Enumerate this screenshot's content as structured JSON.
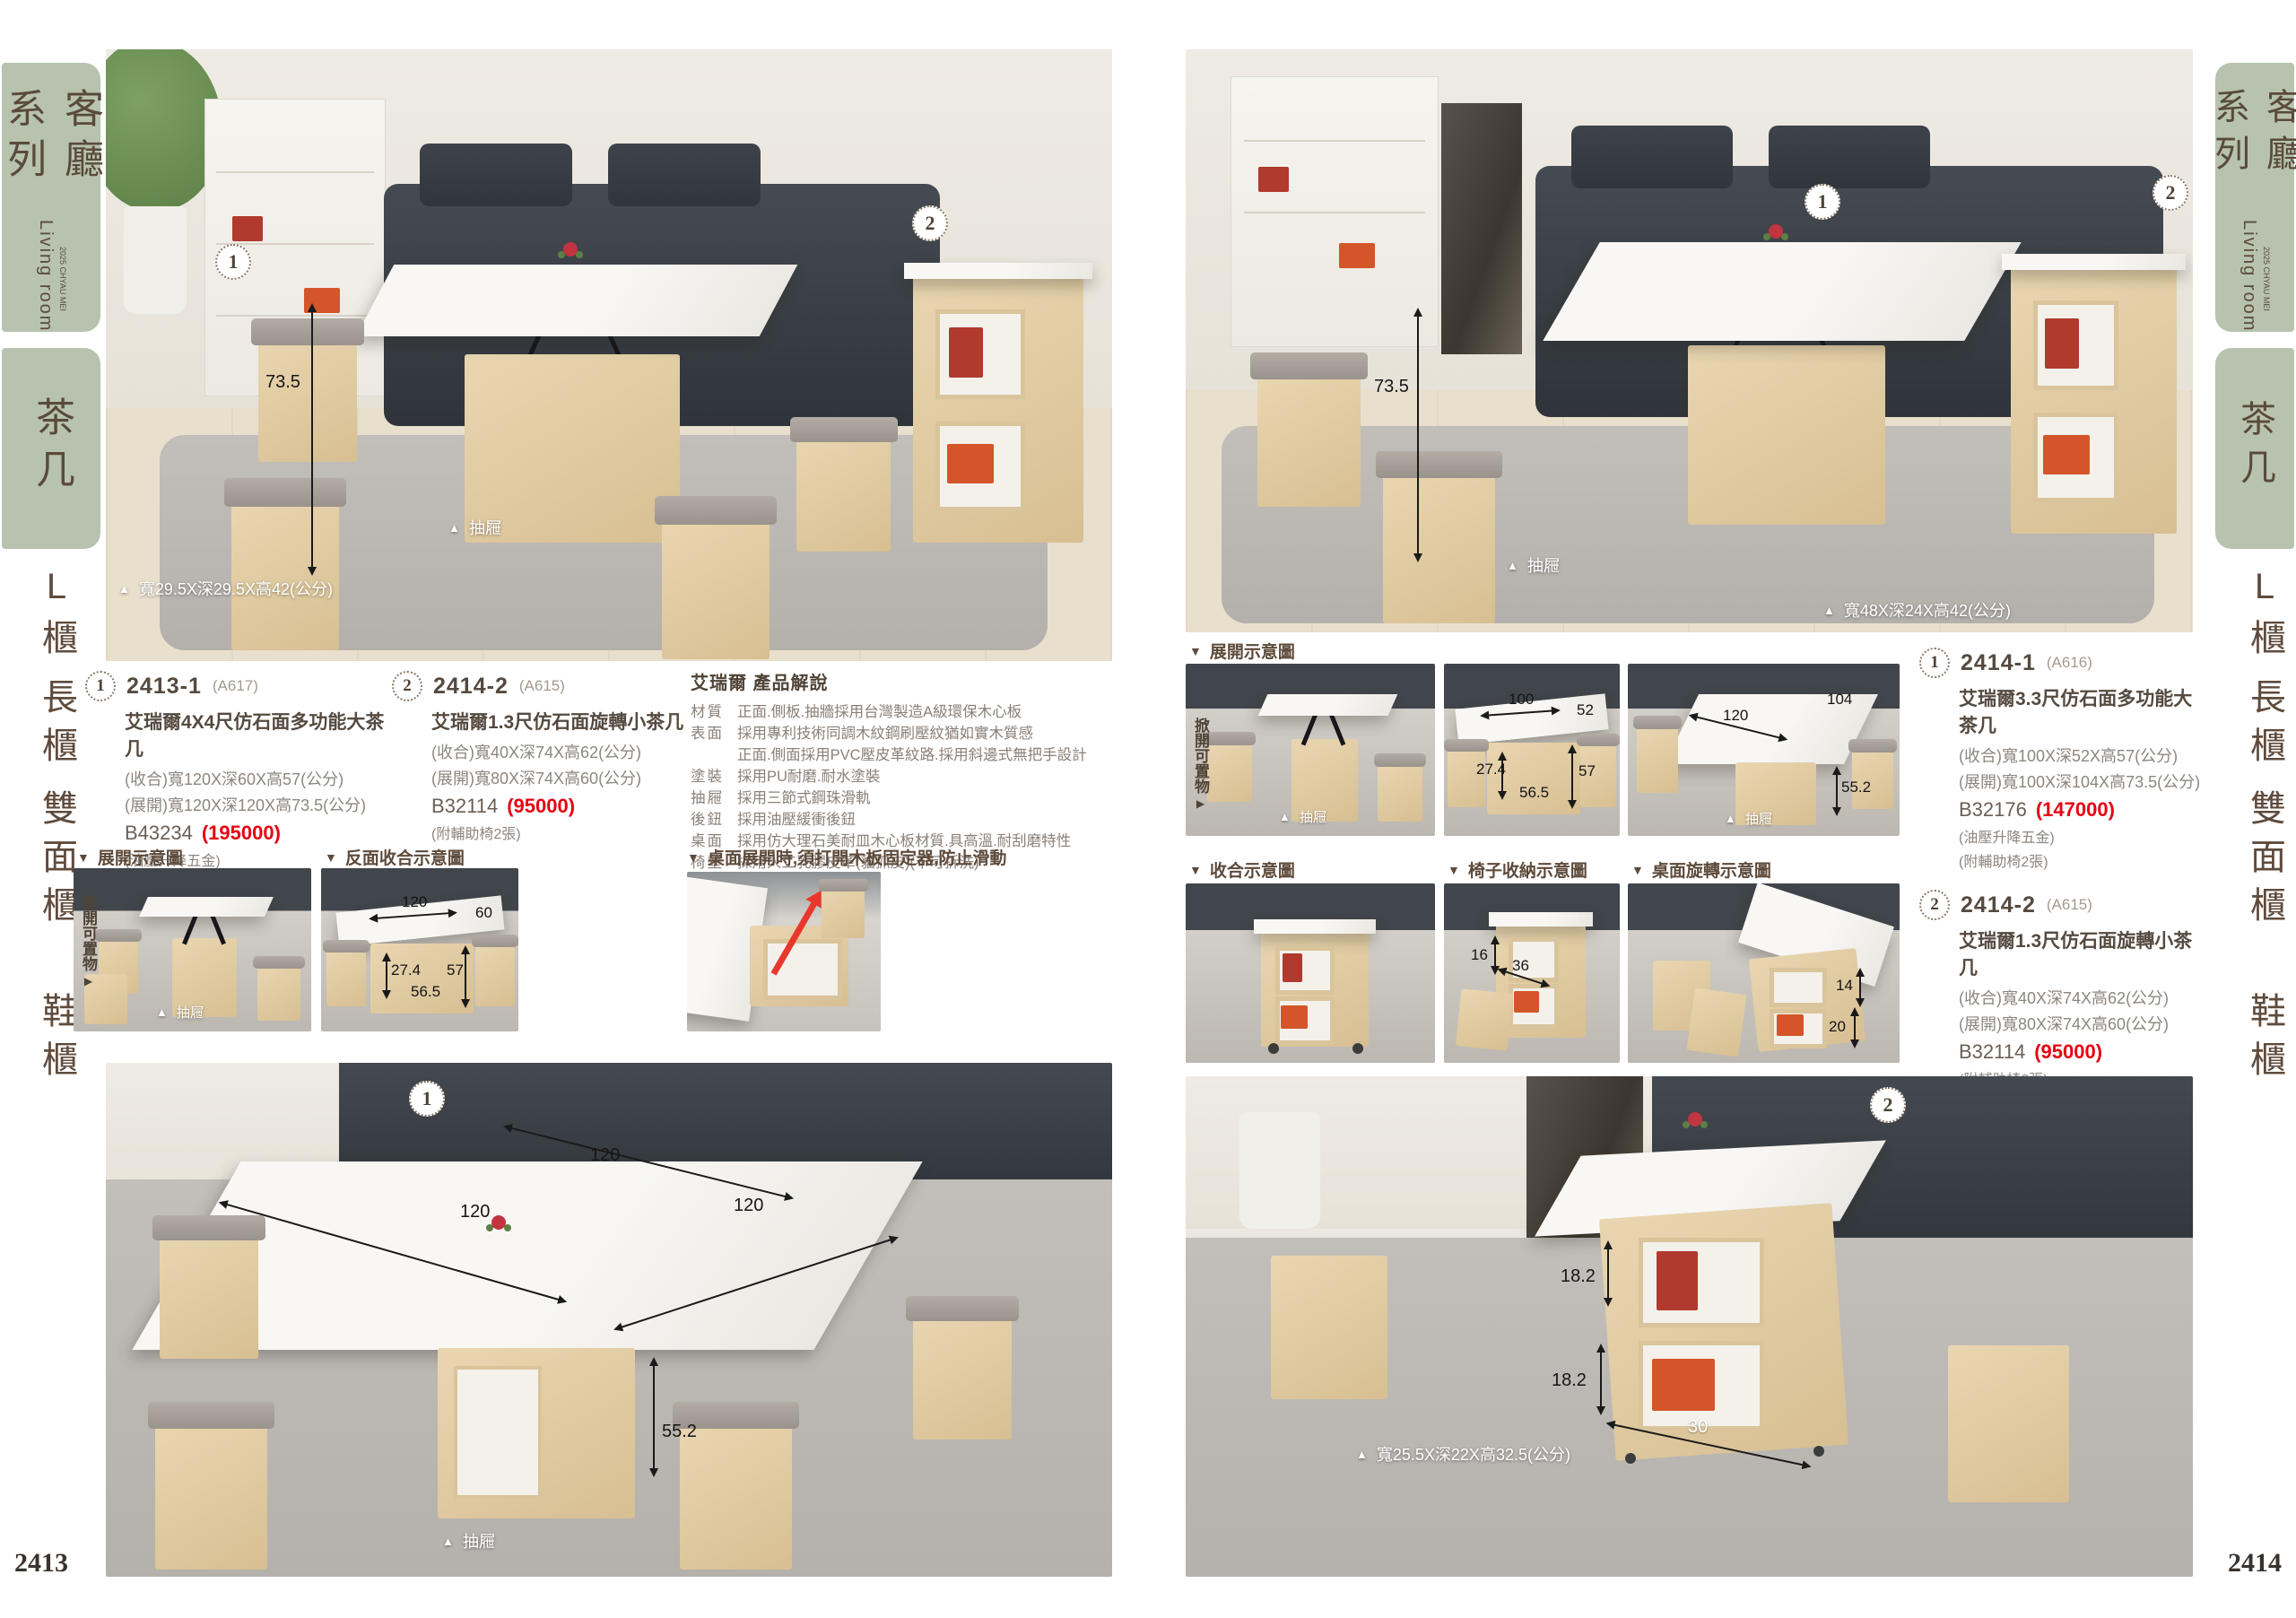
{
  "icons": {
    "up": "▲",
    "down": "▼",
    "right": "▶"
  },
  "page": {
    "left_number": "2413",
    "right_number": "2414"
  },
  "sidebar": {
    "series": "客廳系列",
    "series_en": "Living room",
    "series_tag": "2025 CHYAU MEI",
    "active": "茶几",
    "nav": [
      "L櫃",
      "長櫃",
      "雙面櫃",
      "鞋櫃"
    ]
  },
  "left_page": {
    "hero": {
      "badge1": "1",
      "badge2": "2",
      "height": "73.5",
      "drawer": "抽屜",
      "stool_size": "寬29.5X深29.5X高42(公分)"
    },
    "product1": {
      "badge": "1",
      "model": "2413-1",
      "code": "(A617)",
      "name": "艾瑞爾4X4尺仿石面多功能大茶几",
      "spec_closed": "(收合)寬120X深60X高57(公分)",
      "spec_open": "(展開)寬120X深120X高73.5(公分)",
      "sku": "B43234",
      "price": "(195000)",
      "note1": "(油壓升降五金)",
      "note2": "(附輔助椅4張)"
    },
    "product2": {
      "badge": "2",
      "model": "2414-2",
      "code": "(A615)",
      "name": "艾瑞爾1.3尺仿石面旋轉小茶几",
      "spec_closed": "(收合)寬40X深74X高62(公分)",
      "spec_open": "(展開)寬80X深74X高60(公分)",
      "sku": "B32114",
      "price": "(95000)",
      "note1": "(附輔助椅2張)"
    },
    "desc": {
      "title": "艾瑞爾 產品解說",
      "rows": [
        {
          "label": "材質",
          "text": "正面.側板.抽牆採用台灣製造A級環保木心板"
        },
        {
          "label": "表面",
          "text": "採用專利技術同調木紋鋼刷壓紋猶如實木質感"
        },
        {
          "label": "",
          "text": "正面.側面採用PVC壓皮革紋路.採用斜邊式無把手設計"
        },
        {
          "label": "塗裝",
          "text": "採用PU耐磨.耐水塗裝"
        },
        {
          "label": "抽屜",
          "text": "採用三節式鋼珠滑軌"
        },
        {
          "label": "後鈕",
          "text": "採用油壓緩衝後鈕"
        },
        {
          "label": "桌面",
          "text": "採用仿大理石美耐皿木心板材質.具高溫.耐刮磨特性"
        },
        {
          "label": "椅墊",
          "text": "採用人工乳膠皮革(貓抓皮)(不可拆洗)"
        }
      ]
    },
    "diagram1": {
      "title": "展開示意圖",
      "flip": "掀開可置物",
      "drawer": "抽屜"
    },
    "diagram2": {
      "title": "反面收合示意圖",
      "dim_w": "120",
      "dim_d": "60",
      "dim_h1": "27.4",
      "dim_w2": "56.5",
      "dim_h2": "57"
    },
    "diagram3": {
      "title": "桌面展開時,須打開木板固定器,防止滑動"
    },
    "bottom": {
      "badge": "1",
      "dim_back": "120",
      "dim_left": "120",
      "dim_right": "120",
      "dim_h": "55.2",
      "drawer": "抽屜"
    }
  },
  "right_page": {
    "hero": {
      "badge1": "1",
      "badge2": "2",
      "height": "73.5",
      "drawer": "抽屜",
      "stool_size": "寬48X深24X高42(公分)"
    },
    "row1": {
      "title": "展開示意圖",
      "flip": "掀開可置物",
      "drawer": "抽屜",
      "p2": {
        "dim_w": "100",
        "dim_d": "52",
        "dim_h1": "27.4",
        "dim_w2": "56.5",
        "dim_h2": "57"
      },
      "p3": {
        "dim_w": "120",
        "dim_d": "104",
        "dim_h": "55.2",
        "drawer": "抽屜"
      }
    },
    "product1": {
      "badge": "1",
      "model": "2414-1",
      "code": "(A616)",
      "name": "艾瑞爾3.3尺仿石面多功能大茶几",
      "spec_closed": "(收合)寬100X深52X高57(公分)",
      "spec_open": "(展開)寬100X深104X高73.5(公分)",
      "sku": "B32176",
      "price": "(147000)",
      "note1": "(油壓升降五金)",
      "note2": "(附輔助椅2張)"
    },
    "row2": {
      "t1": "收合示意圖",
      "t2": "椅子收納示意圖",
      "t3": "桌面旋轉示意圖",
      "p2": {
        "dim_h": "16",
        "dim_w": "36"
      },
      "p3": {
        "dim_a": "14",
        "dim_b": "20"
      }
    },
    "product2": {
      "badge": "2",
      "model": "2414-2",
      "code": "(A615)",
      "name": "艾瑞爾1.3尺仿石面旋轉小茶几",
      "spec_closed": "(收合)寬40X深74X高62(公分)",
      "spec_open": "(展開)寬80X深74X高60(公分)",
      "sku": "B32114",
      "price": "(95000)",
      "note1": "(附輔助椅2張)"
    },
    "bottom": {
      "badge": "2",
      "dim1": "18.2",
      "dim2": "18.2",
      "dim3": "30",
      "stool_size": "寬25.5X深22X高32.5(公分)"
    }
  }
}
